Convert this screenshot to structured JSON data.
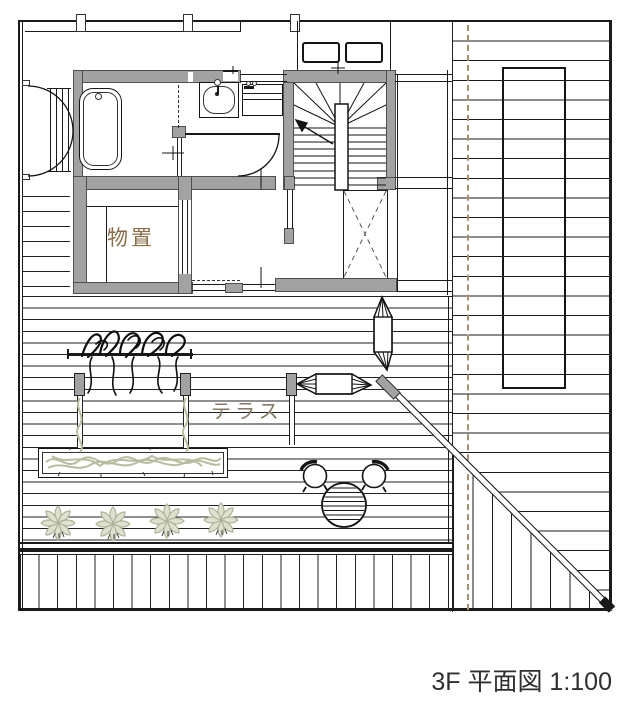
{
  "title": {
    "text": "3F 平面図 1:100",
    "floor": "3F",
    "drawing_type": "平面図",
    "scale": "1:100"
  },
  "labels": {
    "storage": "物置",
    "terrace": "テラス"
  },
  "colors": {
    "wall_gray": "#a2a2a2",
    "line_black": "#1a1a1a",
    "storage_label_brown": "#8a6e49",
    "terrace_label_brown": "#857963",
    "boundary_dashed_tan": "#a8906c",
    "plant_sage": "#b9bda0",
    "title_gray": "#2f2f2f"
  },
  "symbols": [
    "bathtub",
    "double-swing-doors",
    "louver-screen",
    "wash-basin",
    "vanity-counter",
    "staircase-with-winders",
    "up-arrow",
    "void-x-mark",
    "storage-closet",
    "sliding-doors",
    "skylights",
    "roof-deck-boards",
    "boundary-line",
    "sloped-roof-diagonal",
    "pergola-posts",
    "hanging-plants",
    "hammock-horizontal",
    "hammock-vertical",
    "planter-box",
    "star-plants",
    "round-table",
    "garden-chairs",
    "deck-fence"
  ]
}
